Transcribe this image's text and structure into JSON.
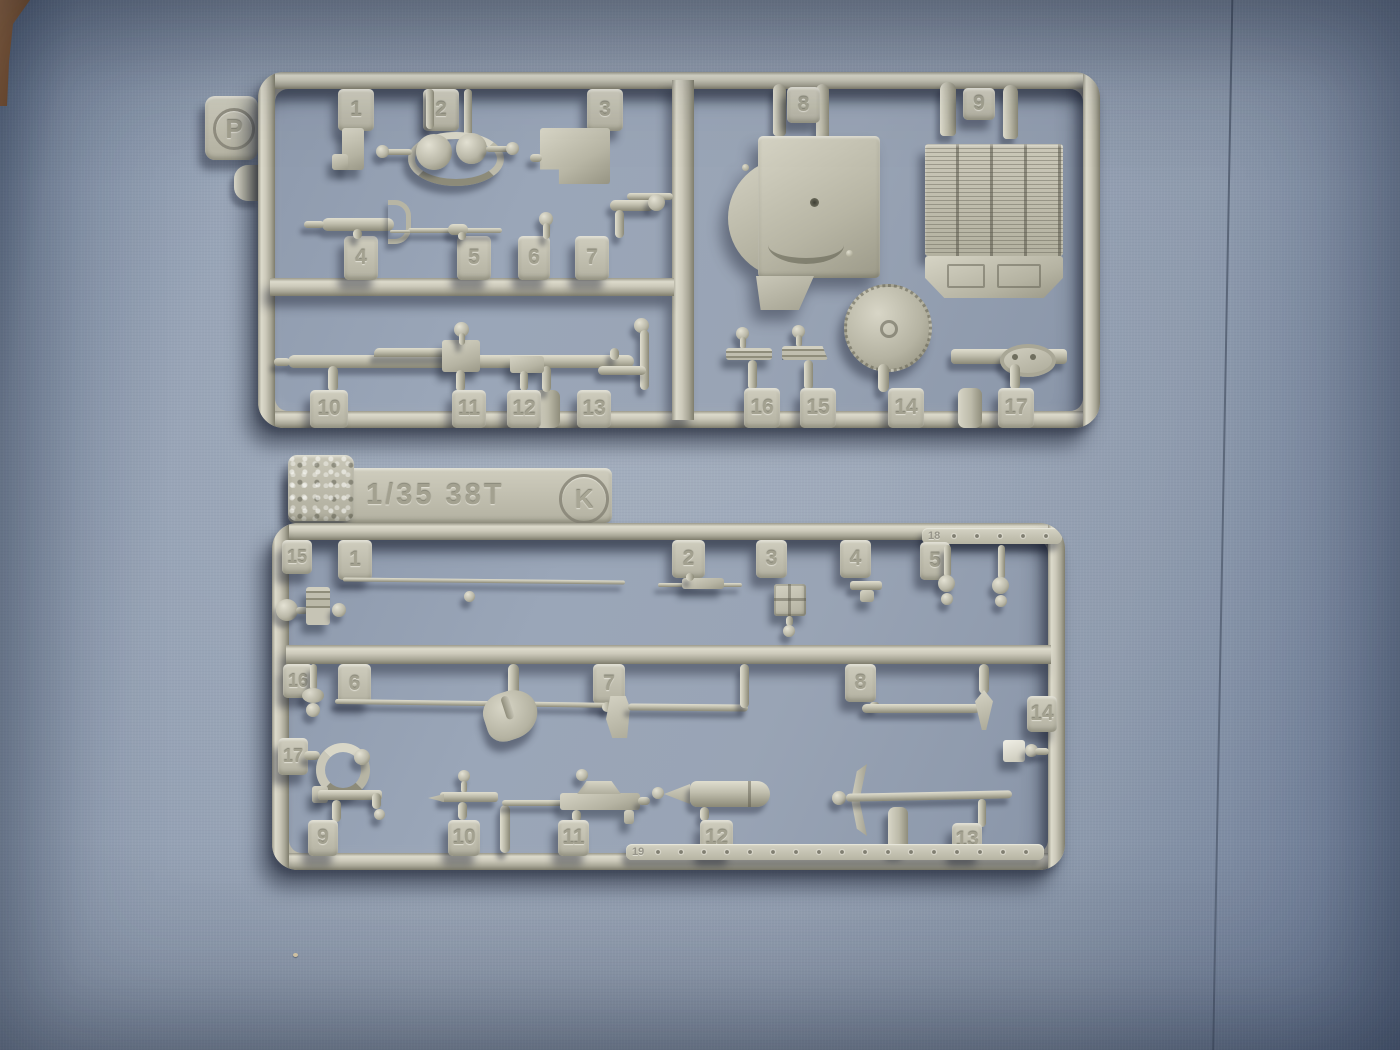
{
  "scene": {
    "description": "Photo of two tan plastic model-kit sprues on blue textured paper",
    "paper_hex": "#97a3b5",
    "plastic_hex": "#bcbaab",
    "shadow_hex": "#171d2d",
    "wood_edge_hex": "#7d4f29"
  },
  "p": {
    "letter": "P",
    "tags": {
      "1": "1",
      "2": "2",
      "3": "3",
      "4": "4",
      "5": "5",
      "6": "6",
      "7": "7",
      "8": "8",
      "9": "9",
      "10": "10",
      "11": "11",
      "12": "12",
      "13": "13",
      "14": "14",
      "15": "15",
      "16": "16",
      "17": "17"
    },
    "parts": [
      "angle-bracket",
      "pulley-with-belt",
      "stowage-box",
      "machine-gun",
      "gun-barrel",
      "ball-lever",
      "starter-crank",
      "final-drive-housing-panel",
      "radiator-grille-panel",
      "long-gun-with-sight",
      "box-with-pin",
      "small-plate",
      "rod-with-ball",
      "toothed-idler-wheel",
      "leaf-spring",
      "leaf-spring",
      "shackle-bar"
    ]
  },
  "k": {
    "letter": "K",
    "title": "1/35 38T",
    "tags": {
      "1": "1",
      "2": "2",
      "3": "3",
      "4": "4",
      "5": "5",
      "6": "6",
      "7": "7",
      "8": "8",
      "9": "9",
      "10": "10",
      "11": "11",
      "12": "12",
      "13": "13",
      "14": "14",
      "15": "15",
      "16": "16",
      "17": "17",
      "18": "18",
      "19": "19"
    },
    "parts": [
      "hinge-block",
      "tow-rod",
      "rifle",
      "hatch-plate",
      "t-bracket",
      "periscope-pins",
      "pin-with-discs",
      "cleaning-rod",
      "shovel",
      "axe",
      "crowbar",
      "clip",
      "tow-ring",
      "tool-bracket",
      "tool-bracket",
      "machine-gun",
      "muffler",
      "pickaxe",
      "rivet-strip",
      "rivet-strip"
    ]
  }
}
